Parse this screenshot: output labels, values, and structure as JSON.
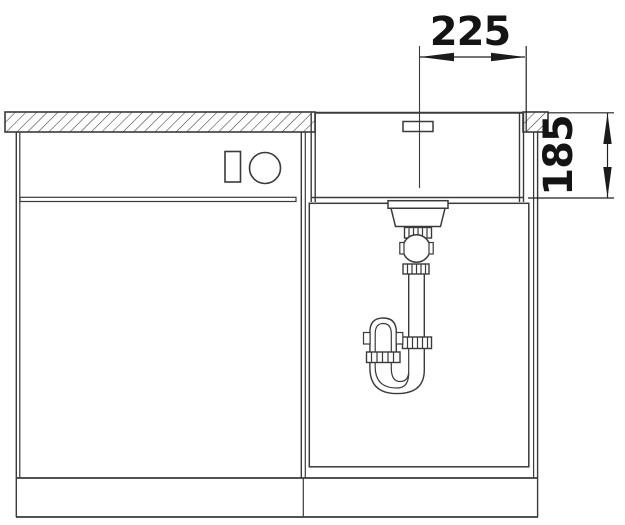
{
  "diagram": {
    "type": "technical-installation-drawing",
    "subject": "undermount-sink-side-section-with-cabinet-and-siphon",
    "background": "#ffffff",
    "line_color": "#3a3a3a",
    "text_color": "#141414",
    "dimensions": {
      "width": {
        "label": "225",
        "orientation": "horizontal"
      },
      "depth": {
        "label": "185",
        "orientation": "vertical"
      }
    },
    "components": [
      "worktop-section-left",
      "worktop-section-right",
      "base-cabinet-left",
      "cabinet-control-rectangle",
      "cabinet-control-circle",
      "sink-bowl",
      "overflow-slot",
      "drain-strainer",
      "siphon-trap",
      "sink-base-cabinet",
      "cabinet-door-panel",
      "plinth"
    ]
  }
}
